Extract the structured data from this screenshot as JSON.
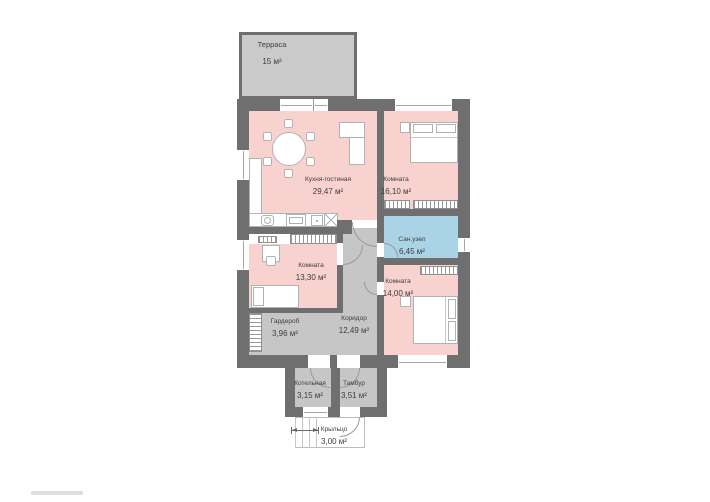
{
  "floorplan": {
    "colors": {
      "wall": "#6f6f6f",
      "room": "#f8d2cf",
      "wet_room": "#abd3e6",
      "utility": "#c6c6c6",
      "terrace": "#cacaca",
      "text": "#3d3d3d"
    },
    "rooms": [
      {
        "id": "terrace",
        "name": "Терраса",
        "area": "15 м²"
      },
      {
        "id": "kitchen_living",
        "name": "Кухня-гостиная",
        "area": "29,47 м²"
      },
      {
        "id": "bedroom_top_right",
        "name": "Комната",
        "area": "16,10 м²"
      },
      {
        "id": "bathroom",
        "name": "Сан.узел",
        "area": "6,45 м²"
      },
      {
        "id": "bedroom_left",
        "name": "Комната",
        "area": "13,30 м²"
      },
      {
        "id": "bedroom_bottom_right",
        "name": "Комната",
        "area": "14,00 м²"
      },
      {
        "id": "wardrobe",
        "name": "Гардероб",
        "area": "3,96 м²"
      },
      {
        "id": "corridor",
        "name": "Коридор",
        "area": "12,49 м²"
      },
      {
        "id": "boiler_room",
        "name": "Котельная",
        "area": "3,15 м²"
      },
      {
        "id": "vestibule",
        "name": "Тамбур",
        "area": "3,51 м²"
      },
      {
        "id": "porch",
        "name": "Крыльцо",
        "area": "3,00 м²"
      }
    ]
  }
}
